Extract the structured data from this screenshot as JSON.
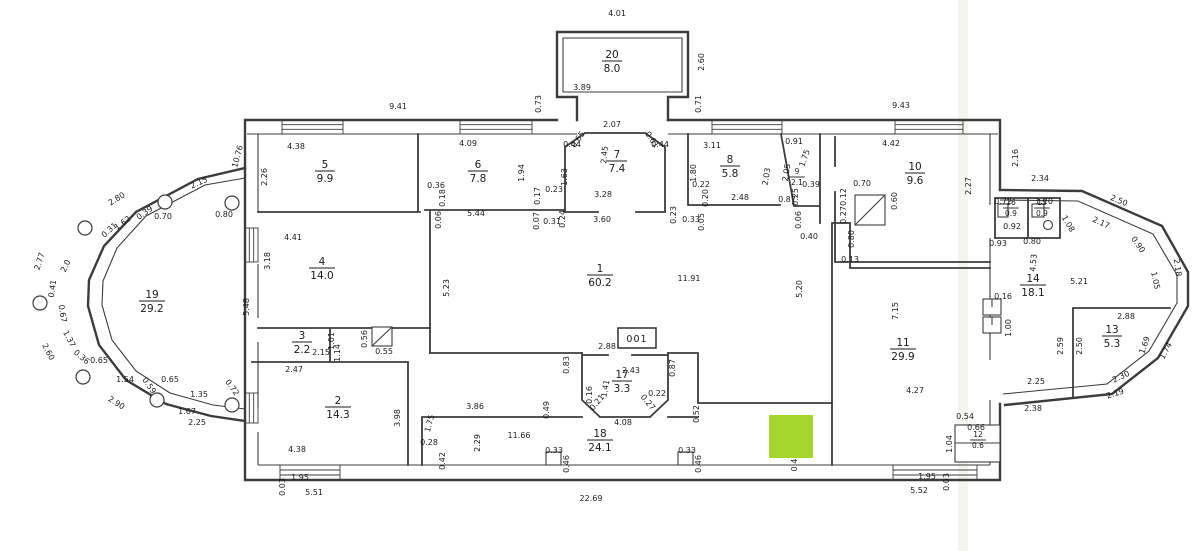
{
  "meta": {
    "document_type": "scanned architectural floor plan",
    "units": "meters / square meters"
  },
  "colors": {
    "background": "#ffffff",
    "line": "#3c3c3c",
    "text": "#1b1b1b",
    "highlight": "#a4d62c",
    "scan_seam": "#f4f4f1"
  },
  "annotations": {
    "unit_label": "001"
  },
  "highlight": {
    "x": 769,
    "y": 415,
    "w": 44,
    "h": 43
  },
  "rooms": [
    {
      "number": "1",
      "area": "60.2",
      "x": 600,
      "y": 272
    },
    {
      "number": "2",
      "area": "14.3",
      "x": 338,
      "y": 404
    },
    {
      "number": "3",
      "area": "2.2",
      "x": 302,
      "y": 339
    },
    {
      "number": "4",
      "area": "14.0",
      "x": 322,
      "y": 265
    },
    {
      "number": "5",
      "area": "9.9",
      "x": 325,
      "y": 168
    },
    {
      "number": "6",
      "area": "7.8",
      "x": 478,
      "y": 168
    },
    {
      "number": "7",
      "area": "7.4",
      "x": 617,
      "y": 158
    },
    {
      "number": "8",
      "area": "5.8",
      "x": 730,
      "y": 163
    },
    {
      "number": "9",
      "area": "2.1",
      "x": 797,
      "y": 174,
      "small": true
    },
    {
      "number": "10",
      "area": "9.6",
      "x": 915,
      "y": 170
    },
    {
      "number": "11",
      "area": "29.9",
      "x": 903,
      "y": 346
    },
    {
      "number": "12",
      "area": "0.6",
      "x": 978,
      "y": 437,
      "small": true
    },
    {
      "number": "13",
      "area": "5.3",
      "x": 1112,
      "y": 333
    },
    {
      "number": "14",
      "area": "18.1",
      "x": 1033,
      "y": 282
    },
    {
      "number": "15",
      "area": "0.9",
      "x": 1042,
      "y": 205,
      "small": true
    },
    {
      "number": "16",
      "area": "0.9",
      "x": 1011,
      "y": 205,
      "small": true
    },
    {
      "number": "17",
      "area": "3.3",
      "x": 622,
      "y": 378
    },
    {
      "number": "18",
      "area": "24.1",
      "x": 600,
      "y": 437
    },
    {
      "number": "19",
      "area": "29.2",
      "x": 152,
      "y": 298
    },
    {
      "number": "20",
      "area": "8.0",
      "x": 612,
      "y": 58
    }
  ],
  "dimensions": [
    {
      "t": "4.01",
      "x": 617,
      "y": 16
    },
    {
      "t": "2.60",
      "x": 704,
      "y": 62,
      "r": -90
    },
    {
      "t": "3.89",
      "x": 582,
      "y": 90
    },
    {
      "t": "0.73",
      "x": 541,
      "y": 104,
      "r": -90
    },
    {
      "t": "0.71",
      "x": 701,
      "y": 104,
      "r": -90
    },
    {
      "t": "2.07",
      "x": 612,
      "y": 127
    },
    {
      "t": "0.65",
      "x": 580,
      "y": 141,
      "r": -55
    },
    {
      "t": "0.61",
      "x": 650,
      "y": 141,
      "r": 55
    },
    {
      "t": "2.45",
      "x": 607,
      "y": 155,
      "r": -85
    },
    {
      "t": "0.44",
      "x": 572,
      "y": 147
    },
    {
      "t": "0.44",
      "x": 660,
      "y": 147
    },
    {
      "t": "1.63",
      "x": 567,
      "y": 177,
      "r": -90
    },
    {
      "t": "3.28",
      "x": 603,
      "y": 197
    },
    {
      "t": "3.60",
      "x": 602,
      "y": 222
    },
    {
      "t": "9.41",
      "x": 398,
      "y": 109
    },
    {
      "t": "4.38",
      "x": 296,
      "y": 149
    },
    {
      "t": "2.26",
      "x": 267,
      "y": 177,
      "r": -90
    },
    {
      "t": "10.76",
      "x": 240,
      "y": 157,
      "r": -75
    },
    {
      "t": "4.09",
      "x": 468,
      "y": 146
    },
    {
      "t": "1.94",
      "x": 524,
      "y": 173,
      "r": -90
    },
    {
      "t": "0.36",
      "x": 436,
      "y": 188
    },
    {
      "t": "0.18",
      "x": 445,
      "y": 198,
      "r": -90
    },
    {
      "t": "0.17",
      "x": 540,
      "y": 196,
      "r": -90
    },
    {
      "t": "0.23",
      "x": 554,
      "y": 192
    },
    {
      "t": "5.44",
      "x": 476,
      "y": 216
    },
    {
      "t": "0.06",
      "x": 441,
      "y": 220,
      "r": -90
    },
    {
      "t": "0.07",
      "x": 539,
      "y": 221,
      "r": -90
    },
    {
      "t": "0.31",
      "x": 552,
      "y": 224
    },
    {
      "t": "0.24",
      "x": 565,
      "y": 219,
      "r": -90
    },
    {
      "t": "9.43",
      "x": 901,
      "y": 108
    },
    {
      "t": "3.11",
      "x": 712,
      "y": 148
    },
    {
      "t": "1.80",
      "x": 696,
      "y": 173,
      "r": -90
    },
    {
      "t": "0.22",
      "x": 701,
      "y": 187
    },
    {
      "t": "0.20",
      "x": 708,
      "y": 198,
      "r": -90
    },
    {
      "t": "2.48",
      "x": 740,
      "y": 200
    },
    {
      "t": "2.03",
      "x": 769,
      "y": 177,
      "r": -80
    },
    {
      "t": "0.91",
      "x": 794,
      "y": 144
    },
    {
      "t": "1.75",
      "x": 807,
      "y": 159,
      "r": -70
    },
    {
      "t": "2.05",
      "x": 789,
      "y": 173,
      "r": -80
    },
    {
      "t": "0.39",
      "x": 811,
      "y": 187
    },
    {
      "t": "0.25",
      "x": 798,
      "y": 197,
      "r": -90
    },
    {
      "t": "0.87",
      "x": 787,
      "y": 202
    },
    {
      "t": "4.42",
      "x": 891,
      "y": 146
    },
    {
      "t": "2.27",
      "x": 971,
      "y": 186,
      "r": -90
    },
    {
      "t": "0.70",
      "x": 862,
      "y": 186
    },
    {
      "t": "0.60",
      "x": 897,
      "y": 201,
      "r": -90
    },
    {
      "t": "0.12",
      "x": 846,
      "y": 197,
      "r": -90
    },
    {
      "t": "0.27",
      "x": 846,
      "y": 215,
      "r": -90
    },
    {
      "t": "2.16",
      "x": 1018,
      "y": 158,
      "r": -90
    },
    {
      "t": "2.34",
      "x": 1040,
      "y": 181
    },
    {
      "t": "2.50",
      "x": 1118,
      "y": 203,
      "r": 22
    },
    {
      "t": "2.17",
      "x": 1100,
      "y": 225,
      "r": 25
    },
    {
      "t": "1.08",
      "x": 1066,
      "y": 225,
      "r": 60
    },
    {
      "t": "0.90",
      "x": 1136,
      "y": 246,
      "r": 55
    },
    {
      "t": "1.05",
      "x": 1153,
      "y": 281,
      "r": 78
    },
    {
      "t": "2.18",
      "x": 1175,
      "y": 268,
      "r": 82
    },
    {
      "t": "0.72",
      "x": 1003,
      "y": 204
    },
    {
      "t": "1.20",
      "x": 1044,
      "y": 204
    },
    {
      "t": "0.92",
      "x": 1012,
      "y": 229
    },
    {
      "t": "0.93",
      "x": 998,
      "y": 246
    },
    {
      "t": "0.80",
      "x": 1032,
      "y": 244
    },
    {
      "t": "5.21",
      "x": 1079,
      "y": 284
    },
    {
      "t": "4.53",
      "x": 1036,
      "y": 263,
      "r": -85
    },
    {
      "t": "0.16",
      "x": 1003,
      "y": 299
    },
    {
      "t": "1.00",
      "x": 1011,
      "y": 328,
      "r": -90
    },
    {
      "t": "2.88",
      "x": 1126,
      "y": 319
    },
    {
      "t": "2.59",
      "x": 1063,
      "y": 346,
      "r": -90
    },
    {
      "t": "2.50",
      "x": 1082,
      "y": 346,
      "r": -90
    },
    {
      "t": "1.69",
      "x": 1147,
      "y": 346,
      "r": -70
    },
    {
      "t": "1.74",
      "x": 1168,
      "y": 352,
      "r": -62
    },
    {
      "t": "2.30",
      "x": 1122,
      "y": 379,
      "r": -25
    },
    {
      "t": "2.25",
      "x": 1036,
      "y": 384
    },
    {
      "t": "2.19",
      "x": 1116,
      "y": 396,
      "r": -18
    },
    {
      "t": "2.38",
      "x": 1033,
      "y": 411
    },
    {
      "t": "2.15",
      "x": 200,
      "y": 185,
      "r": -25
    },
    {
      "t": "2.80",
      "x": 118,
      "y": 201,
      "r": -32
    },
    {
      "t": "1.62",
      "x": 124,
      "y": 225,
      "r": -35
    },
    {
      "t": "0.39",
      "x": 146,
      "y": 215,
      "r": -35
    },
    {
      "t": "0.70",
      "x": 163,
      "y": 219
    },
    {
      "t": "0.80",
      "x": 224,
      "y": 217
    },
    {
      "t": "0.31",
      "x": 111,
      "y": 232,
      "r": -42
    },
    {
      "t": "2.77",
      "x": 42,
      "y": 262,
      "r": -72
    },
    {
      "t": "2.0",
      "x": 68,
      "y": 267,
      "r": -65
    },
    {
      "t": "0.41",
      "x": 55,
      "y": 289,
      "r": -82
    },
    {
      "t": "0.67",
      "x": 60,
      "y": 314,
      "r": 80
    },
    {
      "t": "1.37",
      "x": 67,
      "y": 340,
      "r": 62
    },
    {
      "t": "0.36",
      "x": 80,
      "y": 359,
      "r": 40
    },
    {
      "t": "0.65",
      "x": 99,
      "y": 363
    },
    {
      "t": "2.60",
      "x": 46,
      "y": 353,
      "r": 62
    },
    {
      "t": "1.54",
      "x": 125,
      "y": 382
    },
    {
      "t": "0.59",
      "x": 147,
      "y": 387,
      "r": 55
    },
    {
      "t": "0.65",
      "x": 170,
      "y": 382
    },
    {
      "t": "1.35",
      "x": 199,
      "y": 397
    },
    {
      "t": "0.72",
      "x": 230,
      "y": 389,
      "r": 55
    },
    {
      "t": "2.90",
      "x": 115,
      "y": 405,
      "r": 32
    },
    {
      "t": "1.67",
      "x": 187,
      "y": 414
    },
    {
      "t": "2.25",
      "x": 197,
      "y": 425
    },
    {
      "t": "5.48",
      "x": 249,
      "y": 307,
      "r": -90
    },
    {
      "t": "3.18",
      "x": 270,
      "y": 261,
      "r": -90
    },
    {
      "t": "4.41",
      "x": 293,
      "y": 240
    },
    {
      "t": "5.23",
      "x": 449,
      "y": 288,
      "r": -90
    },
    {
      "t": "11.91",
      "x": 689,
      "y": 281
    },
    {
      "t": "5.20",
      "x": 802,
      "y": 289,
      "r": -90
    },
    {
      "t": "0.40",
      "x": 809,
      "y": 239
    },
    {
      "t": "0.80",
      "x": 854,
      "y": 239,
      "r": -90
    },
    {
      "t": "0.13",
      "x": 850,
      "y": 262
    },
    {
      "t": "7.15",
      "x": 898,
      "y": 311,
      "r": -90
    },
    {
      "t": "0.23",
      "x": 676,
      "y": 215,
      "r": -90
    },
    {
      "t": "0.33",
      "x": 691,
      "y": 222
    },
    {
      "t": "0.05",
      "x": 704,
      "y": 222,
      "r": -90
    },
    {
      "t": "0.06",
      "x": 801,
      "y": 220,
      "r": -90
    },
    {
      "t": "2.47",
      "x": 294,
      "y": 372
    },
    {
      "t": "2.15",
      "x": 321,
      "y": 355
    },
    {
      "t": "1.01",
      "x": 334,
      "y": 341,
      "r": -90
    },
    {
      "t": "1.14",
      "x": 340,
      "y": 353,
      "r": -90
    },
    {
      "t": "0.56",
      "x": 367,
      "y": 339,
      "r": -90
    },
    {
      "t": "0.55",
      "x": 384,
      "y": 354
    },
    {
      "t": "4.38",
      "x": 297,
      "y": 452
    },
    {
      "t": "3.98",
      "x": 400,
      "y": 418,
      "r": -90
    },
    {
      "t": "1.95",
      "x": 300,
      "y": 480
    },
    {
      "t": "0.03",
      "x": 285,
      "y": 487,
      "r": -90
    },
    {
      "t": "5.51",
      "x": 314,
      "y": 495
    },
    {
      "t": "2.88",
      "x": 607,
      "y": 349
    },
    {
      "t": "0.83",
      "x": 569,
      "y": 365,
      "r": -90
    },
    {
      "t": "2.43",
      "x": 631,
      "y": 373
    },
    {
      "t": "0.87",
      "x": 675,
      "y": 368,
      "r": -90
    },
    {
      "t": "1.41",
      "x": 608,
      "y": 389,
      "r": -80
    },
    {
      "t": "0.16",
      "x": 592,
      "y": 395,
      "r": -90
    },
    {
      "t": "0.21",
      "x": 599,
      "y": 404,
      "r": -50
    },
    {
      "t": "0.27",
      "x": 646,
      "y": 404,
      "r": 50
    },
    {
      "t": "0.22",
      "x": 657,
      "y": 396
    },
    {
      "t": "4.08",
      "x": 623,
      "y": 425
    },
    {
      "t": "0.49",
      "x": 549,
      "y": 410,
      "r": -90
    },
    {
      "t": "0.52",
      "x": 699,
      "y": 414,
      "r": -90
    },
    {
      "t": "3.86",
      "x": 475,
      "y": 409
    },
    {
      "t": "1.75",
      "x": 432,
      "y": 424,
      "r": -75
    },
    {
      "t": "2.29",
      "x": 480,
      "y": 443,
      "r": -90
    },
    {
      "t": "11.66",
      "x": 519,
      "y": 438
    },
    {
      "t": "0.28",
      "x": 429,
      "y": 445
    },
    {
      "t": "0.42",
      "x": 445,
      "y": 461,
      "r": -90
    },
    {
      "t": "0.33",
      "x": 554,
      "y": 453
    },
    {
      "t": "0.46",
      "x": 569,
      "y": 464,
      "r": -90
    },
    {
      "t": "0.33",
      "x": 687,
      "y": 453
    },
    {
      "t": "0.46",
      "x": 701,
      "y": 464,
      "r": -90
    },
    {
      "t": "0.4",
      "x": 797,
      "y": 465,
      "r": -90
    },
    {
      "t": "22.69",
      "x": 591,
      "y": 501
    },
    {
      "t": "4.27",
      "x": 915,
      "y": 393
    },
    {
      "t": "0.54",
      "x": 965,
      "y": 419
    },
    {
      "t": "0.66",
      "x": 976,
      "y": 430
    },
    {
      "t": "1.04",
      "x": 952,
      "y": 444,
      "r": -90
    },
    {
      "t": "1.95",
      "x": 927,
      "y": 479
    },
    {
      "t": "5.52",
      "x": 919,
      "y": 493
    },
    {
      "t": "0.03",
      "x": 949,
      "y": 482,
      "r": -90
    }
  ]
}
